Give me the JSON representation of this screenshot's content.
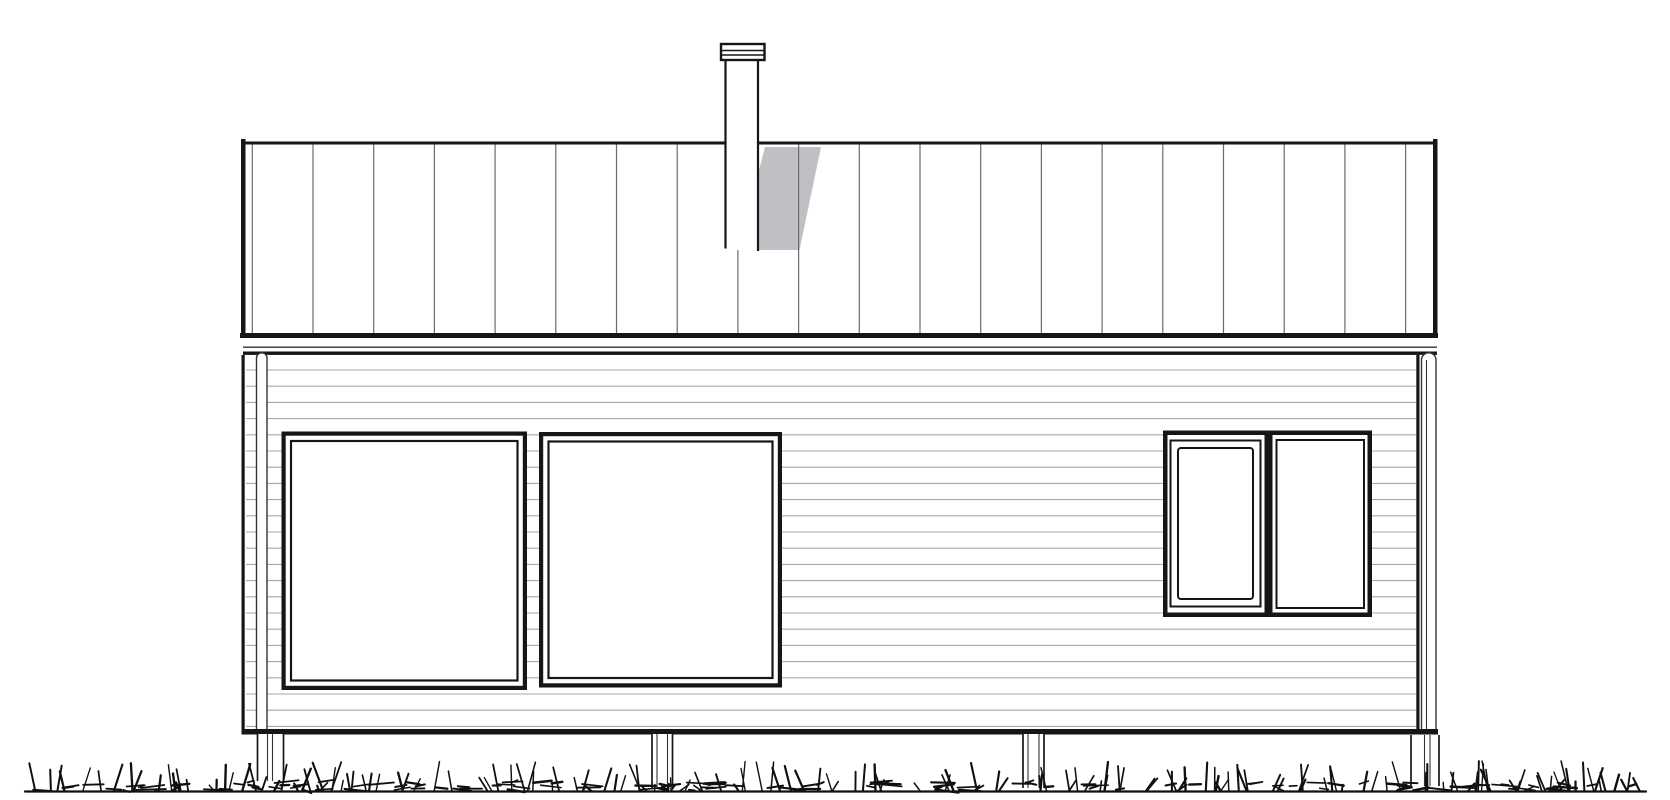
{
  "meta": {
    "description": "Black-and-white architectural side elevation drawing: single-storey house on foundation posts, standing-seam roof with chimney and cast shadow, horizontal siding, two large square windows, one two-pane window, scribbled grass at grade"
  },
  "colors": {
    "background": "#ffffff",
    "heavy_line": "#161616",
    "medium_line": "#333333",
    "seam_line": "#6b6b6b",
    "siding_line": "#a8a8a8",
    "shadow_fill": "#c0c0c4",
    "grass_line": "#101010",
    "glass": "#ffffff"
  },
  "canvas": {
    "width": 1670,
    "height": 800
  },
  "roof": {
    "left": 243,
    "right": 1436,
    "top": 142,
    "eave": 337,
    "top_edge_thickness": 3.0,
    "verge_thickness": 4.5,
    "verge_top": 139,
    "seam_first_x": 252.3,
    "seam_spacing": 60.7,
    "seam_count": 20
  },
  "chimney": {
    "pipe_left": 725.5,
    "pipe_right": 758,
    "pipe_top": 60,
    "pipe_bottom": 250,
    "cap_left": 721,
    "cap_right": 764.5,
    "cap_top": 44,
    "cap_bottom": 60,
    "cap_band_lines": [
      50.5,
      55
    ]
  },
  "roof_shadow": {
    "points": [
      [
        765,
        147
      ],
      [
        821,
        147
      ],
      [
        799.5,
        250
      ],
      [
        758,
        250
      ],
      [
        758,
        174
      ]
    ]
  },
  "eave_fascia": {
    "bar1": {
      "x": 240,
      "y": 333,
      "width": 1198,
      "height": 5.0
    },
    "line": {
      "x": 243,
      "y": 346.5,
      "width": 1194,
      "height": 1.4
    },
    "bar2": {
      "x": 243,
      "y": 351.5,
      "width": 1194,
      "height": 3.4
    }
  },
  "wall": {
    "left": 241.5,
    "right": 1419.5,
    "top": 355,
    "bottom": 734.5,
    "edge_thickness": 3.2,
    "bottom_bar": {
      "x": 242,
      "y": 729,
      "width": 1196,
      "height": 5.5
    }
  },
  "siding": {
    "first_y": 370,
    "spacing": 16.2,
    "last_y": 727,
    "x1": 246,
    "x2": 1416
  },
  "windows": {
    "frame": {
      "outer_thickness": 4.2,
      "gap": 4.2,
      "inner_thickness": 2.2
    },
    "large_left": {
      "x": 281.5,
      "y": 431.5,
      "width": 245.5,
      "height": 258.5
    },
    "large_center": {
      "x": 539,
      "y": 432,
      "width": 243,
      "height": 255.5
    },
    "right_unit": {
      "x": 1163,
      "y": 430.5,
      "width": 209,
      "height": 186.5,
      "outer_thickness": 4.5,
      "mullion_x": 1264.5,
      "mullion_width": 8,
      "left_sash_outer": {
        "x": 1170.5,
        "y": 440.5,
        "width": 90,
        "height": 166
      },
      "left_sash_inner": {
        "x": 1178,
        "y": 448,
        "width": 75,
        "height": 151
      },
      "right_pane": {
        "x": 1276.5,
        "y": 440,
        "width": 87.5,
        "height": 168
      }
    }
  },
  "downspouts": {
    "left": {
      "x": 256.5,
      "width": 10.5,
      "top": 358,
      "bottom": 733
    },
    "right": {
      "x": 1421.5,
      "width": 14.5,
      "top": 360,
      "bottom": 734,
      "inner_line_offset": 5
    }
  },
  "posts": [
    {
      "x": 257.5,
      "width": 26,
      "top": 734,
      "bottom": 781,
      "inner_offsets": [
        10,
        15
      ]
    },
    {
      "x": 652,
      "width": 20.5,
      "top": 734,
      "bottom": 788,
      "inner_offsets": [
        5,
        15.5
      ]
    },
    {
      "x": 1023,
      "width": 21,
      "top": 734,
      "bottom": 788,
      "inner_offsets": [
        5,
        16
      ]
    },
    {
      "x": 1411,
      "width": 28,
      "top": 735,
      "bottom": 786,
      "inner_offsets": [
        13.5,
        19
      ]
    }
  ],
  "ground": {
    "x1": 25,
    "x2": 1646,
    "y": 791.5,
    "thickness": 2.2
  },
  "grass": {
    "seed": 11,
    "count": 300,
    "x_min": 30,
    "x_max": 1640,
    "base_y": 791,
    "max_blade": 26
  }
}
